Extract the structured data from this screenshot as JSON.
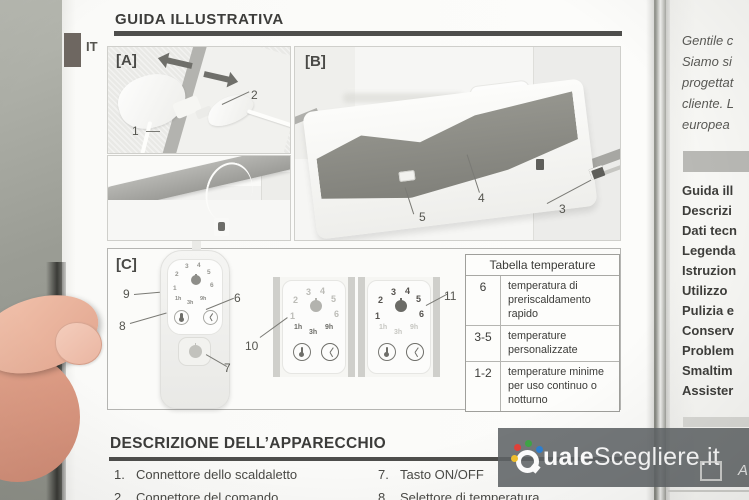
{
  "header": {
    "lang_tab": "IT",
    "title": "GUIDA ILLUSTRATIVA"
  },
  "panel_a": {
    "label": "[A]",
    "callouts": {
      "n1": "1",
      "n2": "2"
    }
  },
  "panel_b": {
    "label": "[B]",
    "callouts": {
      "n3": "3",
      "n4": "4",
      "n5": "5"
    }
  },
  "panel_c": {
    "label": "[C]",
    "callouts": {
      "n6": "6",
      "n7": "7",
      "n8": "8",
      "n9": "9",
      "n10": "10",
      "n11": "11"
    }
  },
  "remote_display": {
    "digits": [
      "1",
      "2",
      "3",
      "4",
      "5",
      "6"
    ],
    "hours": [
      "1h",
      "3h",
      "9h"
    ],
    "icons": [
      "power-icon",
      "thermometer-icon",
      "timer-icon"
    ]
  },
  "temperature_table": {
    "title": "Tabella temperature",
    "rows": [
      {
        "range": "6",
        "description": "temperatura di preriscaldamento rapido"
      },
      {
        "range": "3-5",
        "description": "temperature personalizzate"
      },
      {
        "range": "1-2",
        "description": "temperature minime per uso continuo o notturno"
      }
    ]
  },
  "description_section": {
    "title": "DESCRIZIONE DELL’APPARECCHIO",
    "left_items": [
      {
        "num": "1.",
        "text": "Connettore dello scaldaletto"
      },
      {
        "num": "2.",
        "text": "Connettore del comando"
      }
    ],
    "right_items": [
      {
        "num": "7.",
        "text": "Tasto ON/OFF"
      },
      {
        "num": "8.",
        "text": "Selettore di temperatura"
      }
    ]
  },
  "next_page": {
    "intro_lines": [
      "Gentile c",
      "Siamo si",
      "progettat",
      "cliente. L",
      "europea"
    ],
    "toc": [
      "Guida ill",
      "Descrizi",
      "Dati tecn",
      "Legenda",
      "Istruzion",
      "Utilizzo",
      "Pulizia e",
      "Conserv",
      "Problem",
      "Smaltim",
      "Assister"
    ]
  },
  "watermark": {
    "bold": "uale",
    "regular": "Scegliere.it",
    "side_letter": "A"
  },
  "colors": {
    "dot_red": "#e0413a",
    "dot_green": "#3fa546",
    "dot_blue": "#2f80d0",
    "dot_yellow": "#f2c12e",
    "band": "#606466",
    "rule": "#4e4e4c"
  }
}
